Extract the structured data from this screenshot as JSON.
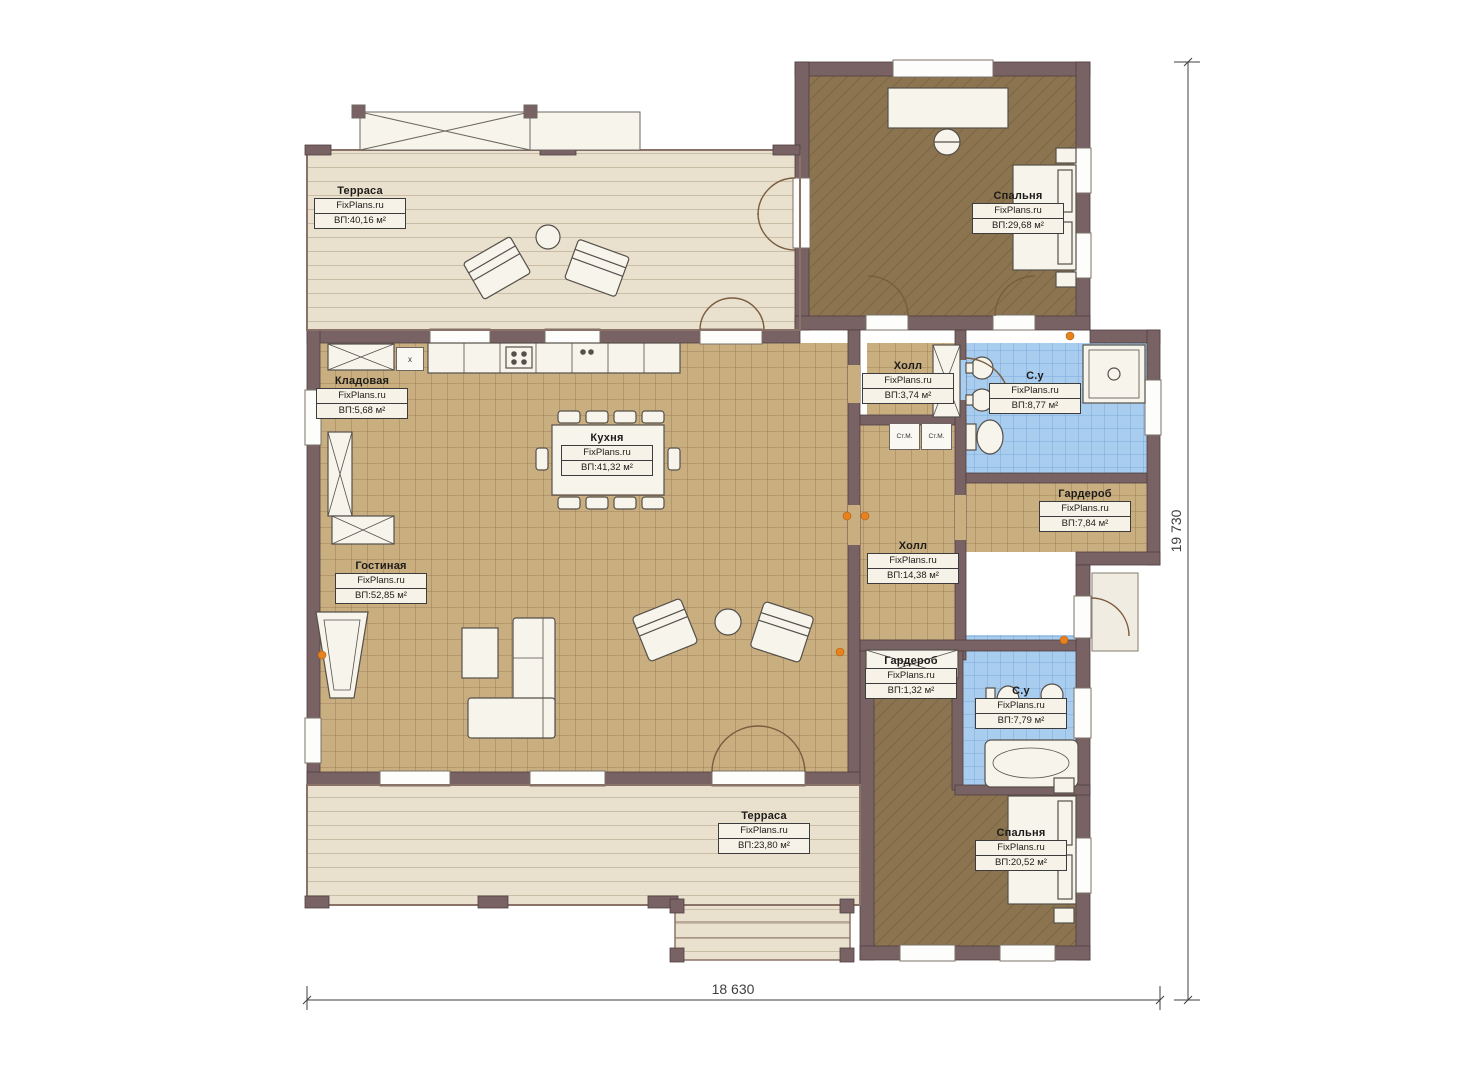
{
  "brand": "FixPlans.ru",
  "rooms": [
    {
      "id": "terrace-top",
      "name": "Терраса",
      "area": "ВП:40,16 м²"
    },
    {
      "id": "bedroom-top",
      "name": "Спальня",
      "area": "ВП:29,68 м²"
    },
    {
      "id": "storage",
      "name": "Кладовая",
      "area": "ВП:5,68 м²"
    },
    {
      "id": "kitchen",
      "name": "Кухня",
      "area": "ВП:41,32 м²"
    },
    {
      "id": "living-room",
      "name": "Гостиная",
      "area": "ВП:52,85 м²"
    },
    {
      "id": "hall-small",
      "name": "Холл",
      "area": "ВП:3,74 м²"
    },
    {
      "id": "bathroom-top",
      "name": "С.у",
      "area": "ВП:8,77 м²"
    },
    {
      "id": "wardrobe-right",
      "name": "Гардероб",
      "area": "ВП:7,84 м²"
    },
    {
      "id": "hall-main",
      "name": "Холл",
      "area": "ВП:14,38 м²"
    },
    {
      "id": "wardrobe-small",
      "name": "Гардероб",
      "area": "ВП:1,32 м²"
    },
    {
      "id": "bathroom-bottom",
      "name": "С.у",
      "area": "ВП:7,79 м²"
    },
    {
      "id": "bedroom-bottom",
      "name": "Спальня",
      "area": "ВП:20,52 м²"
    },
    {
      "id": "terrace-bottom",
      "name": "Терраса",
      "area": "ВП:23,80 м²"
    }
  ],
  "appliances": {
    "washer_left": "Ст.М.",
    "washer_right": "Ст.М.",
    "kitchen_box": "x"
  },
  "dimensions": {
    "width_mm": "18 630",
    "height_mm": "19 730"
  },
  "colors": {
    "wall": "#796264",
    "tile_floor": "#c9ae80",
    "terrace_floor": "#e9e0cd",
    "bedroom_floor": "#8b744f",
    "bath_floor": "#a9cdef",
    "label_box_bg": "#f6f2e7",
    "accent_orange": "#e8821e"
  }
}
